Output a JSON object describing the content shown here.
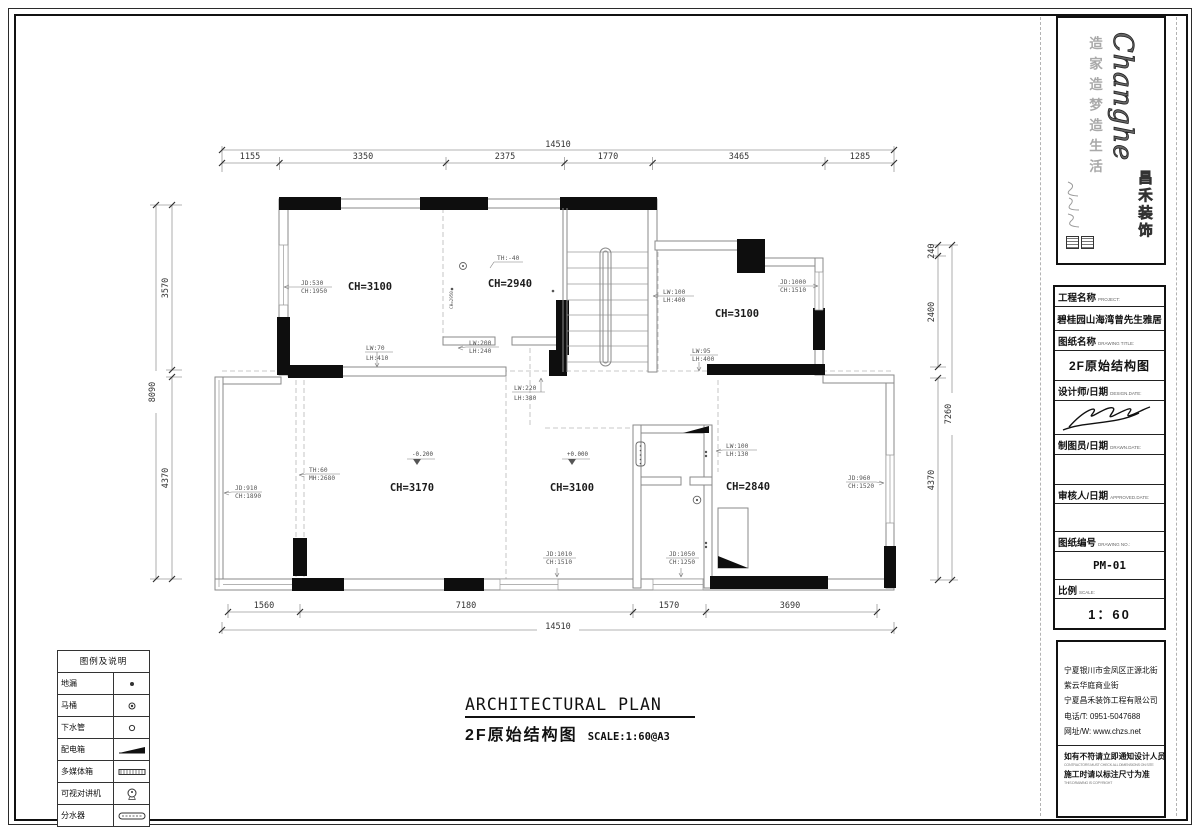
{
  "plan": {
    "rooms": [
      "CH=3100",
      "CH=2940",
      "CH=3100",
      "CH=3170",
      "CH=3100",
      "CH=2840"
    ],
    "tiny_room_label": "CH=2950",
    "levels": {
      "left": "-0.200",
      "right": "+0.000"
    },
    "dims": {
      "top": {
        "overall": "14510",
        "segments": [
          "1155",
          "3350",
          "2375",
          "1770",
          "3465",
          "1285"
        ]
      },
      "bottom": {
        "overall": "14510",
        "segments": [
          "1560",
          "7180",
          "1570",
          "3690"
        ]
      },
      "left": {
        "overall": "8090",
        "segments": [
          "3570",
          "4370"
        ]
      },
      "right": {
        "overall": "7260",
        "segments": [
          "240",
          "2400",
          "4370"
        ]
      }
    },
    "annotations": {
      "a1": {
        "l1": "JD:530",
        "l2": "CH:1950"
      },
      "a2": {
        "l1": "TH:-40",
        "l2": ""
      },
      "a3": {
        "l1": "LW:70",
        "l2": "LH:410"
      },
      "a4": {
        "l1": "LW:200",
        "l2": "LH:240"
      },
      "a5": {
        "l1": "LW:220",
        "l2": "LH:380"
      },
      "a6": {
        "l1": "LW:100",
        "l2": "LH:400"
      },
      "a7": {
        "l1": "JD:1000",
        "l2": "CH:1510"
      },
      "a8": {
        "l1": "LW:95",
        "l2": "LH:400"
      },
      "a9": {
        "l1": "JD:910",
        "l2": "CH:1890"
      },
      "a10": {
        "l1": "TH:60",
        "l2": "MH:2680"
      },
      "a11": {
        "l1": "JD:1010",
        "l2": "CH:1510"
      },
      "a12": {
        "l1": "JD:1050",
        "l2": "CH:1250"
      },
      "a13": {
        "l1": "LW:100",
        "l2": "LH:130"
      },
      "a14": {
        "l1": "JD:960",
        "l2": "CH:1520"
      }
    }
  },
  "title_bar": {
    "en": "ARCHITECTURAL PLAN",
    "cn": "2F原始结构图",
    "scale": "SCALE:1:60@A3"
  },
  "legend": {
    "title": "图例及说明",
    "rows": [
      {
        "label": "地漏"
      },
      {
        "label": "马桶"
      },
      {
        "label": "下水管"
      },
      {
        "label": "配电箱"
      },
      {
        "label": "多媒体箱"
      },
      {
        "label": "可视对讲机"
      },
      {
        "label": "分水器"
      }
    ]
  },
  "logo": {
    "wordmark": "Changhe",
    "brand": "昌禾装饰",
    "slogan": "造家造梦造生活"
  },
  "title_block": {
    "project_label": "工程名称",
    "project_label_en": "PROJECT:",
    "project_value": "碧桂园山海湾曾先生雅居",
    "drawing_label": "图纸名称",
    "drawing_label_en": "DRAWING TITLE:",
    "drawing_value": "2F原始结构图",
    "designer_label": "设计师/日期",
    "designer_label_en": "DESIGN.DATE:",
    "drafter_label": "制图员/日期",
    "drafter_label_en": "DRAWN.DATE:",
    "approver_label": "审核人/日期",
    "approver_label_en": "APPROVED.DATE:",
    "no_label": "图纸编号",
    "no_label_en": "DRAWING NO.:",
    "no_value": "PM-01",
    "scale_label": "比例",
    "scale_label_en": "SCALE:",
    "scale_value": "1：60"
  },
  "address_block": {
    "lines": [
      "宁夏银川市金凤区正源北街",
      "紫云华庭商业街",
      "宁夏昌禾装饰工程有限公司",
      "电话/T: 0951-5047688",
      "网址/W: www.chzs.net"
    ],
    "note1_cn": "如有不符请立即通知设计人员",
    "note1_en": "CONTRACTORS MUST CHECK ALL DIMENSIONS ON SITE",
    "note2_cn": "施工时请以标注尺寸为准",
    "note2_en": "THIS DRAWING IS COPYRIGHT"
  }
}
